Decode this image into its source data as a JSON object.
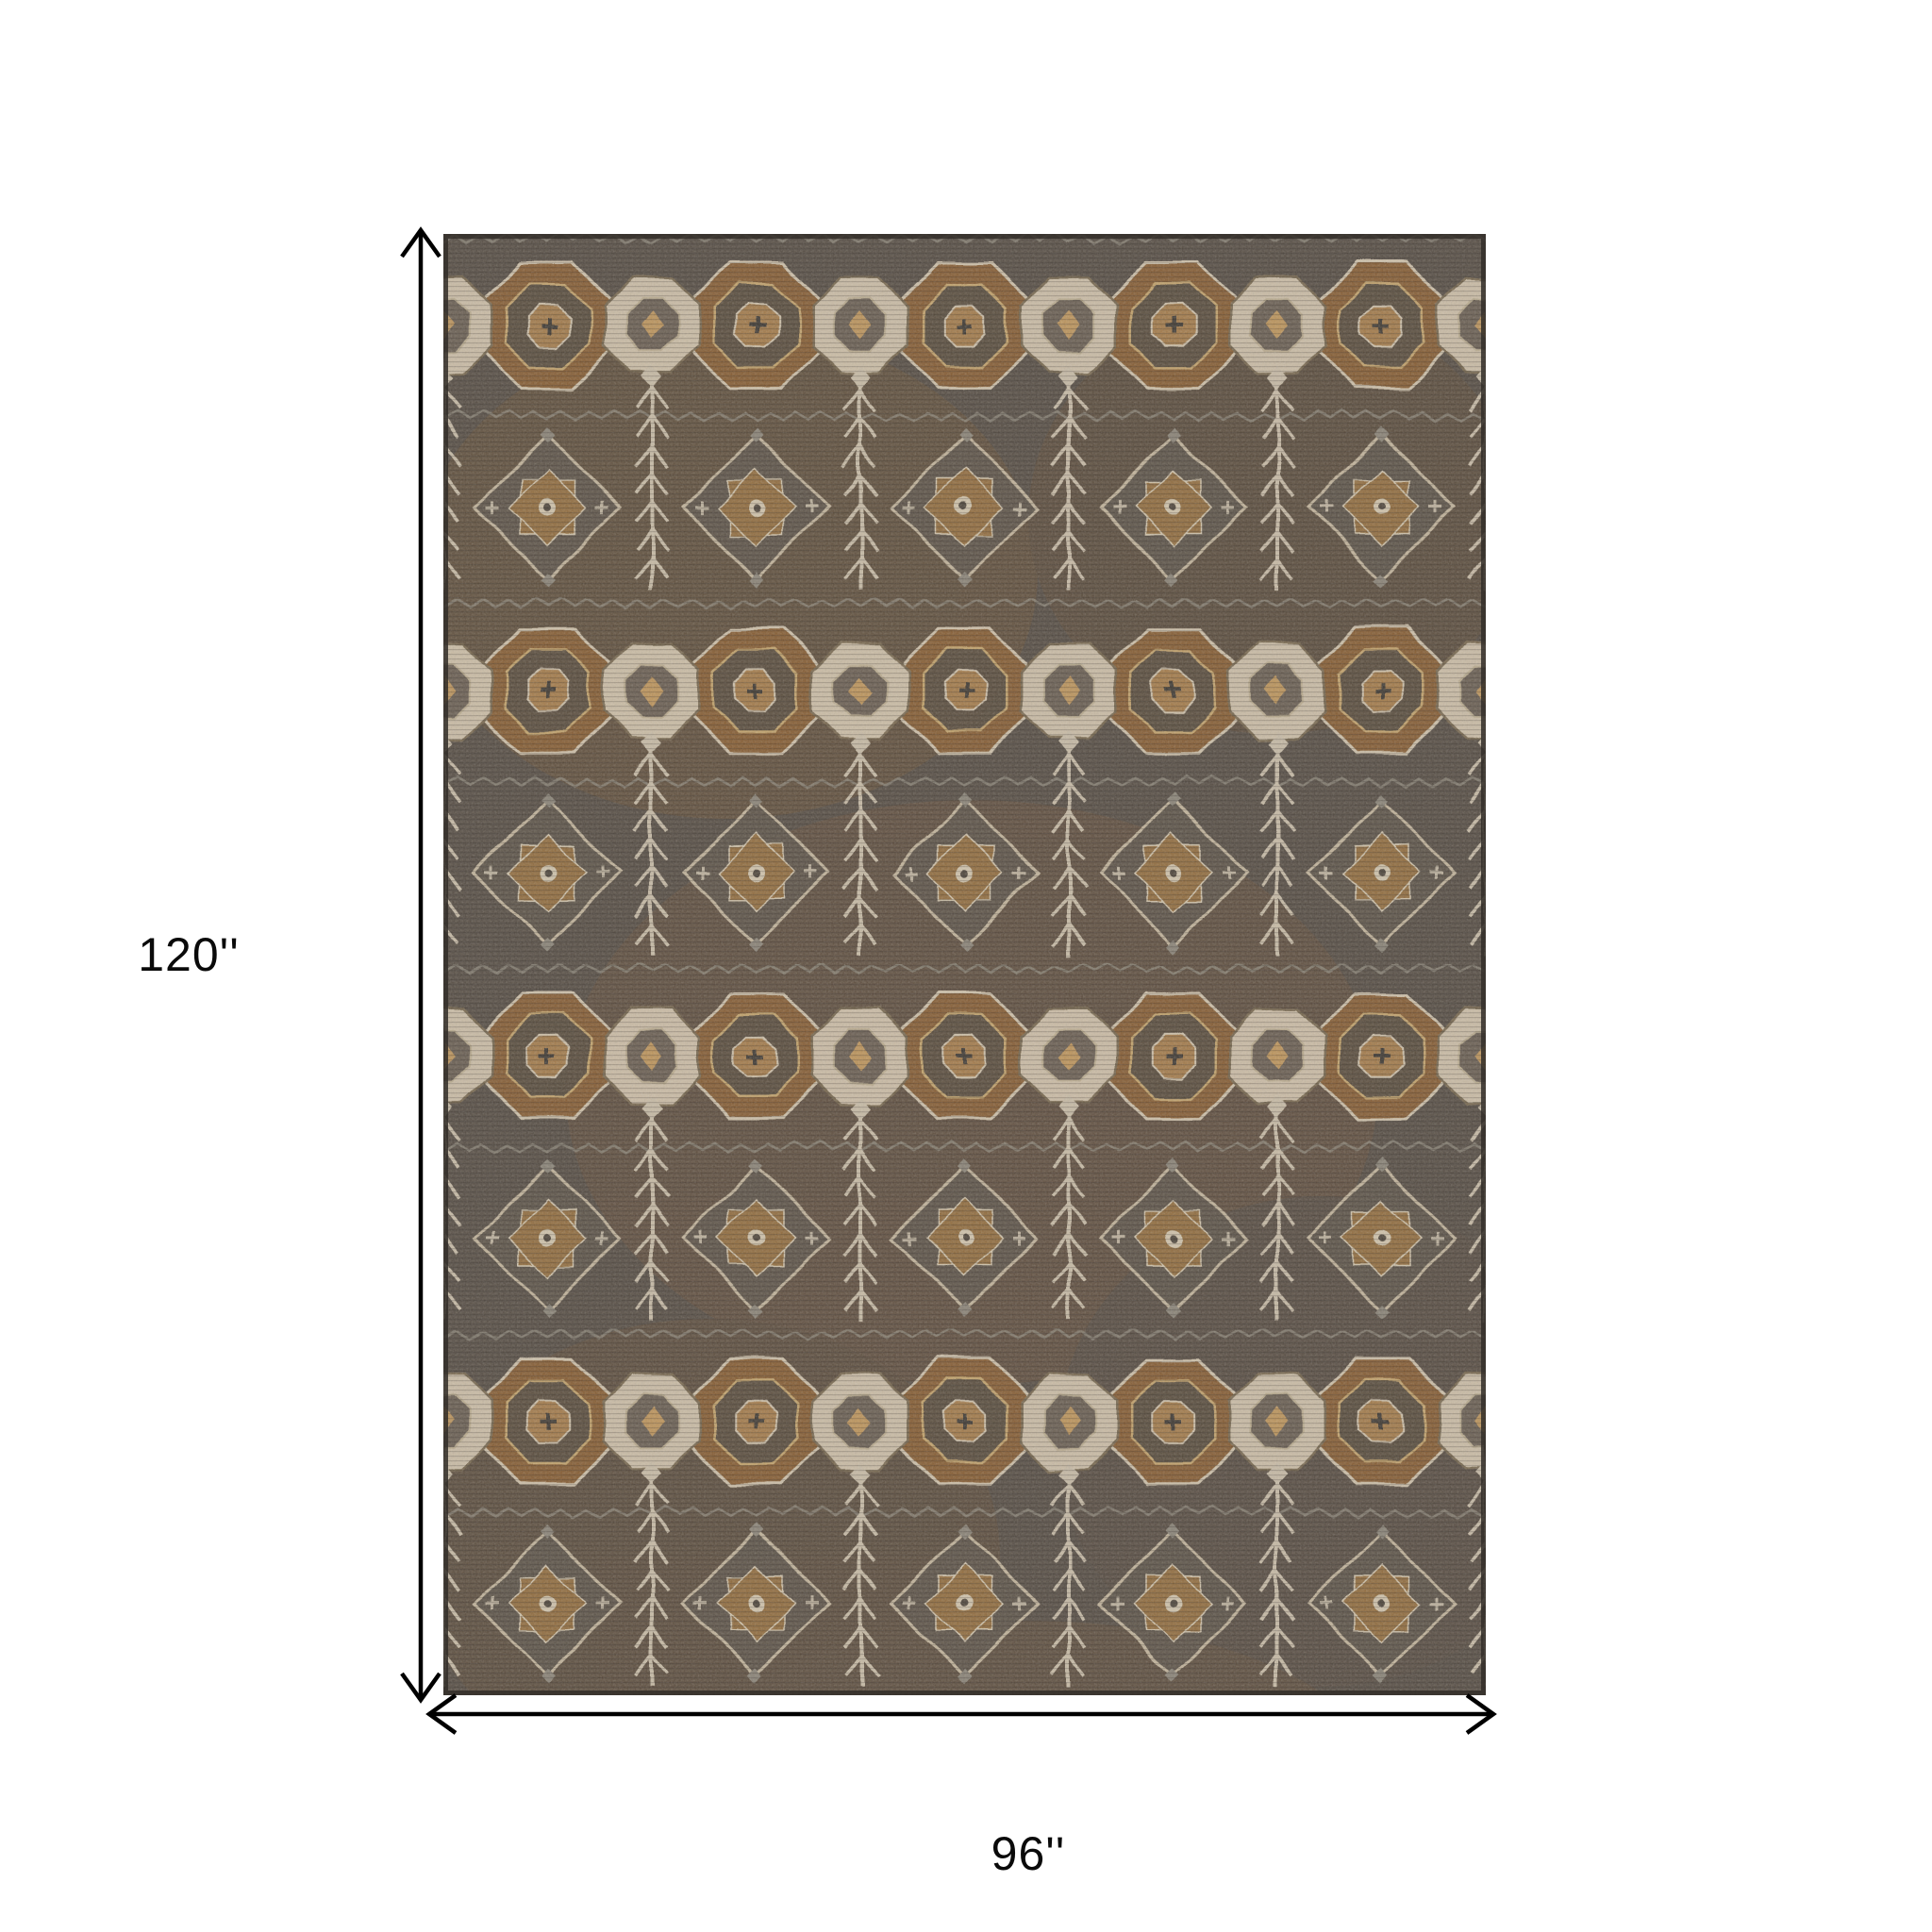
{
  "diagram": {
    "type": "product-dimension-diagram",
    "background_color": "#ffffff",
    "arrow_color": "#000000",
    "label_color": "#0a0a0a"
  },
  "dimensions": {
    "height_label": "120''",
    "height_inches": 120,
    "width_label": "96''",
    "width_inches": 96
  },
  "rug": {
    "description": "distressed oriental area rug with medallion, diamond and herringbone tree motifs",
    "colors": {
      "ground": "#584f46",
      "brown": "#8a6136",
      "light_brown": "#a97f4e",
      "cream": "#d3c5ae",
      "gray": "#8e887c",
      "dark": "#3f3a34",
      "border": "#332e29"
    }
  }
}
